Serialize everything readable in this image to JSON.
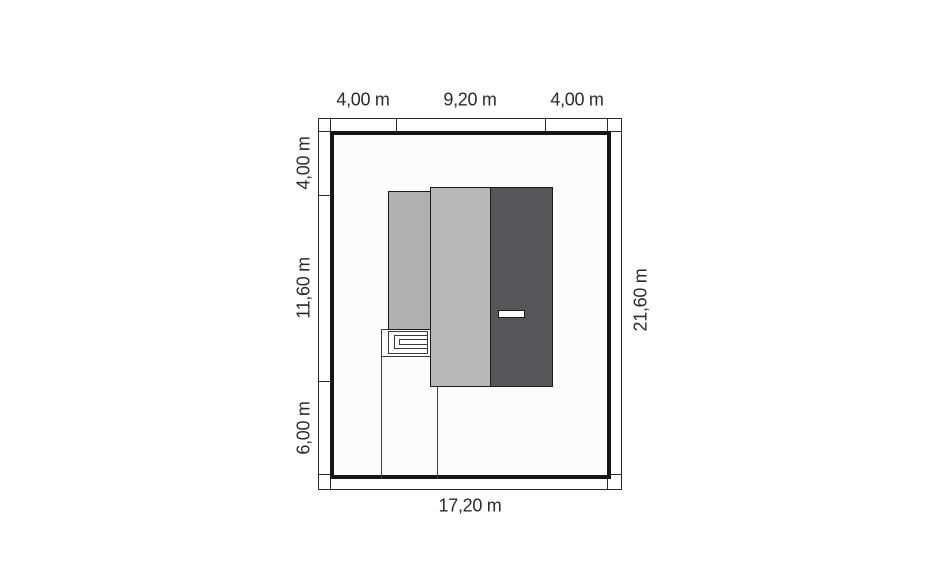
{
  "plan": {
    "dimensions": {
      "top": [
        "4,00 m",
        "9,20 m",
        "4,00 m"
      ],
      "left": [
        "4,00 m",
        "11,60 m",
        "6,00 m"
      ],
      "right": [
        "21,60 m"
      ],
      "bottom": [
        "17,20 m"
      ]
    },
    "colors": {
      "boundary": "#161618",
      "band_line": "#2a2a2c",
      "garage_fill": "#b0b0b0",
      "house_fill": "#b8b8b8",
      "dark_block_fill": "#565659",
      "marker_fill": "#ffffff",
      "plot_interior": "#fcfcfc",
      "label_color": "#2b2b2e"
    }
  }
}
